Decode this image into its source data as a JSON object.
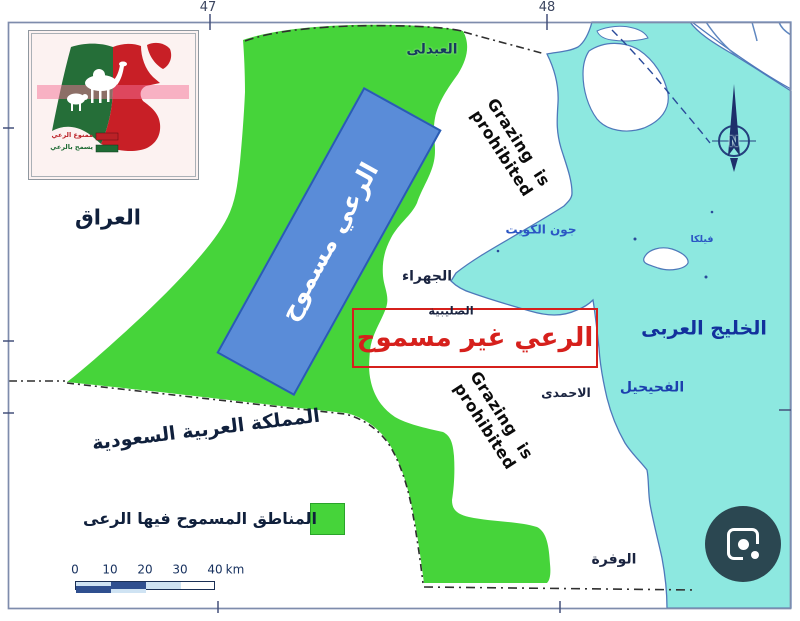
{
  "map": {
    "grid_labels": {
      "left": "47",
      "right": "48"
    },
    "countries": {
      "iraq": "العراق",
      "saudi": "المملكة العربية السعودية"
    },
    "water": {
      "bay": "جون الكويت",
      "gulf": "الخليج العربى",
      "island": "فيلكا"
    },
    "places": {
      "abdali": "العبدلى",
      "jahra": "الجهراء",
      "sulaibiya": "الصليبية",
      "ahmadi": "الاحمدى",
      "fahaheel": "الفحيحيل",
      "wafra": "الوفرة"
    },
    "zones": {
      "allowed_rect_label": "الرعي مسموح",
      "not_allowed_label": "الرعي غير مسموح",
      "grazing_line1": "Grazing is",
      "grazing_line2": "prohibited"
    },
    "legend": {
      "allowed_areas_label": "المناطق المسموح فيها الرعى"
    },
    "scale": {
      "ticks": [
        "0",
        "10",
        "20",
        "30",
        "40"
      ],
      "unit": "km"
    },
    "compass": {
      "north": "N"
    },
    "inset": {
      "legend": [
        {
          "label": "ممنوع الرعي",
          "color": "#bb2127"
        },
        {
          "label": "يسمح بالرعي",
          "color": "#1e6b34"
        }
      ]
    },
    "colors": {
      "grazing_green": "#46d43a",
      "water_cyan": "#8de8e0",
      "allowed_rect_blue": "#5a8cd8",
      "prohibited_red": "#d6201c",
      "inset_green": "#256e38",
      "inset_red": "#c81f26",
      "lens_button": "#2b4751"
    }
  }
}
